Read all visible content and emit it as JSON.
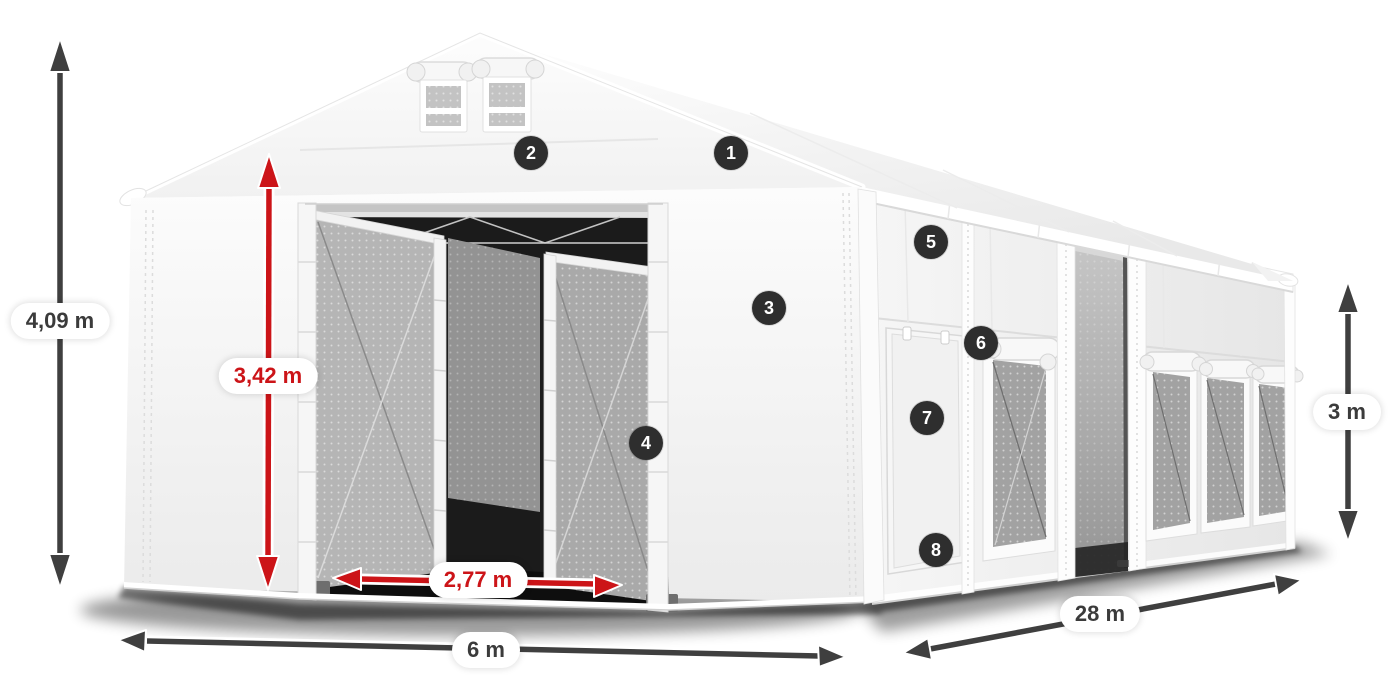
{
  "diagram": {
    "dimensions": {
      "total_height": "4,09 m",
      "entrance_height": "3,42 m",
      "entrance_width": "2,77 m",
      "width": "6 m",
      "length": "28 m",
      "side_height": "3 m"
    },
    "markers": {
      "m1": "1",
      "m2": "2",
      "m3": "3",
      "m4": "4",
      "m5": "5",
      "m6": "6",
      "m7": "7",
      "m8": "8"
    },
    "colors": {
      "dimension_red": "#cc1418",
      "dimension_dark": "#3f3f3f",
      "marker_bg": "#2e2e2e",
      "tent_white": "#f7f7f7"
    }
  }
}
